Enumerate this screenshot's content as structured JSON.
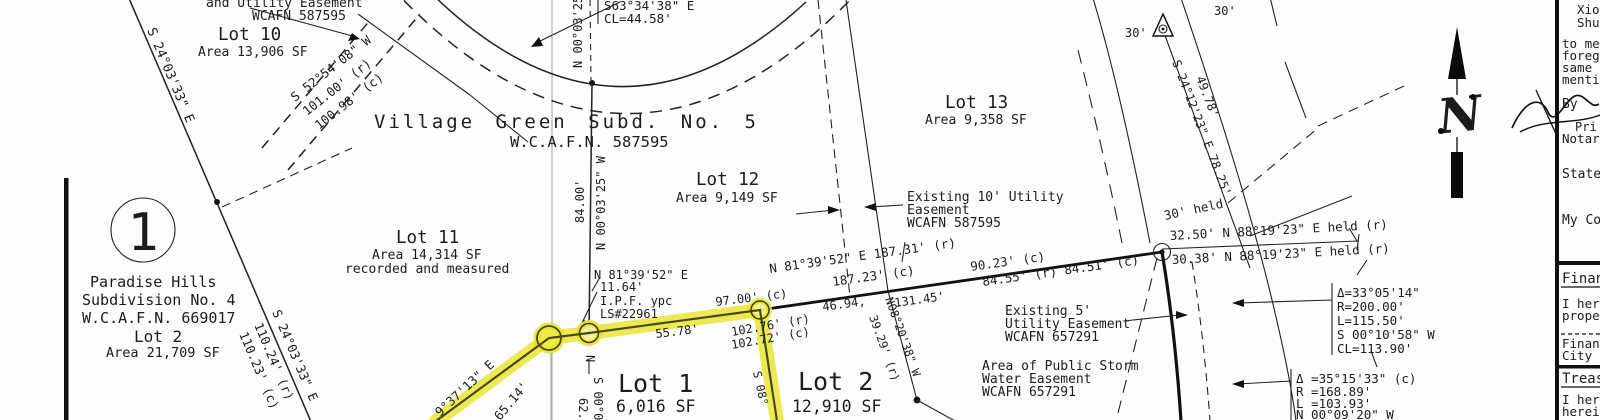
{
  "plat": {
    "subdivision": {
      "title": "Village Green Subd. No. 5",
      "recording": "W.C.A.F.N. 587595"
    },
    "lots": {
      "lot10": {
        "name": "Lot 10",
        "area": "Area 13,906 SF"
      },
      "lot11": {
        "name": "Lot 11",
        "area": "Area 14,314 SF",
        "note": "recorded and measured"
      },
      "lot12": {
        "name": "Lot 12",
        "area": "Area 9,149 SF"
      },
      "lot13": {
        "name": "Lot 13",
        "area": "Area 9,358 SF"
      },
      "lot1": {
        "name": "Lot 1",
        "area": "6,016 SF"
      },
      "lot2": {
        "name": "Lot 2",
        "area": "12,910 SF"
      }
    },
    "adjacent_parcel": {
      "number": "1",
      "name": "Paradise Hills",
      "subdivision": "Subdivision No. 4",
      "recording": "W.C.A.F.N. 669017",
      "lot": "Lot 2",
      "area": "Area 21,709 SF"
    },
    "easements": {
      "top": {
        "line1": "and Utility Easement",
        "line2": "WCAFN 587595"
      },
      "util10": {
        "line1": "Existing 10' Utility",
        "line2": "Easement",
        "line3": "WCAFN 587595"
      },
      "util5": {
        "line1": "Existing 5'",
        "line2": "Utility Easement",
        "line3": "WCAFN 657291"
      },
      "storm": {
        "line1": "Area of Public Storm",
        "line2": "Water Easement",
        "line3": "WCAFN 657291"
      }
    },
    "monument": {
      "ipf1": "I.P.F. ypc",
      "ipf2": "LS#22961"
    },
    "north_arrow": "N",
    "dimensions": {
      "s24_e": "S 24°03'33\" E",
      "s24_b": "S 24°03'33\" E",
      "d110r": "110.24' (r)",
      "d110c": "110.23' (c)",
      "s52": "S 52°54'08\" W",
      "d101r": "101.00' (r)",
      "d101c": "100.98' (c)",
      "n00w": "N 00°03'25\" W",
      "d84": "84.00'",
      "n00top": "N 00°03'25",
      "n81": "N 81°39'52\" E",
      "d1164": "11.64'",
      "d5578": "55.78'",
      "d9700": "97.00' (c)",
      "d10276": "102.76' (r)",
      "d10272": "102.72' (c)",
      "n81main": "N 81°39'52\" E 187.31' (r)",
      "d18723": "187.23' (c)",
      "d4694": "46.94,",
      "d13145": "131.45'",
      "d9023": "90.23' (c)",
      "d8455": "84.55' (r) 84.51' (c)",
      "n08": "N08°20'38\" W",
      "d3929": "39.29' (r)",
      "s24_12": "S 24°12'23\" E 78.25'",
      "d4978": "49.78'",
      "d30a": "30'",
      "d30b": "30'",
      "held30": "30' held",
      "held1": "32.50' N 88°19'23\" E held (r)",
      "held2": "30.38' N 88°19'23\" E held (r)",
      "b3713": "9°37'13\" E",
      "d6514": "65.14'",
      "s08": "S 08°",
      "fragN": "N",
      "fragS": "S 00°0",
      "frag62": "62."
    },
    "curves": {
      "top": {
        "bearing": "S63°34'38\" E",
        "chord": "CL=44.58'"
      },
      "c1": {
        "l1": "Δ=33°05'14\"",
        "l2": "R=200.00'",
        "l3": "L=115.50'",
        "l4": "S 00°10'58\" W",
        "l5": "CL=113.90'"
      },
      "c2": {
        "l1": "Δ =35°15'33\" (c)",
        "l2": "R =168.89'",
        "l3": "L =103.93'",
        "l4": "N 00°09'20\" W"
      }
    }
  },
  "title_block": {
    "name_line1": "Xio",
    "name_line2": "Shu",
    "ack_lines": [
      "to me",
      "forego",
      "same",
      "menti"
    ],
    "by_label": "By",
    "printed_fragment": "Pri",
    "notary_fragment": "Notary",
    "state_fragment": "State",
    "commission_fragment": "My Co",
    "finance": {
      "heading": "Finan",
      "line1": "I here",
      "line2": "proper",
      "sig1": "Financ",
      "sig2": "City o"
    },
    "treasurer": {
      "heading": "Treas",
      "line1": "I here",
      "line2": "herein"
    }
  }
}
